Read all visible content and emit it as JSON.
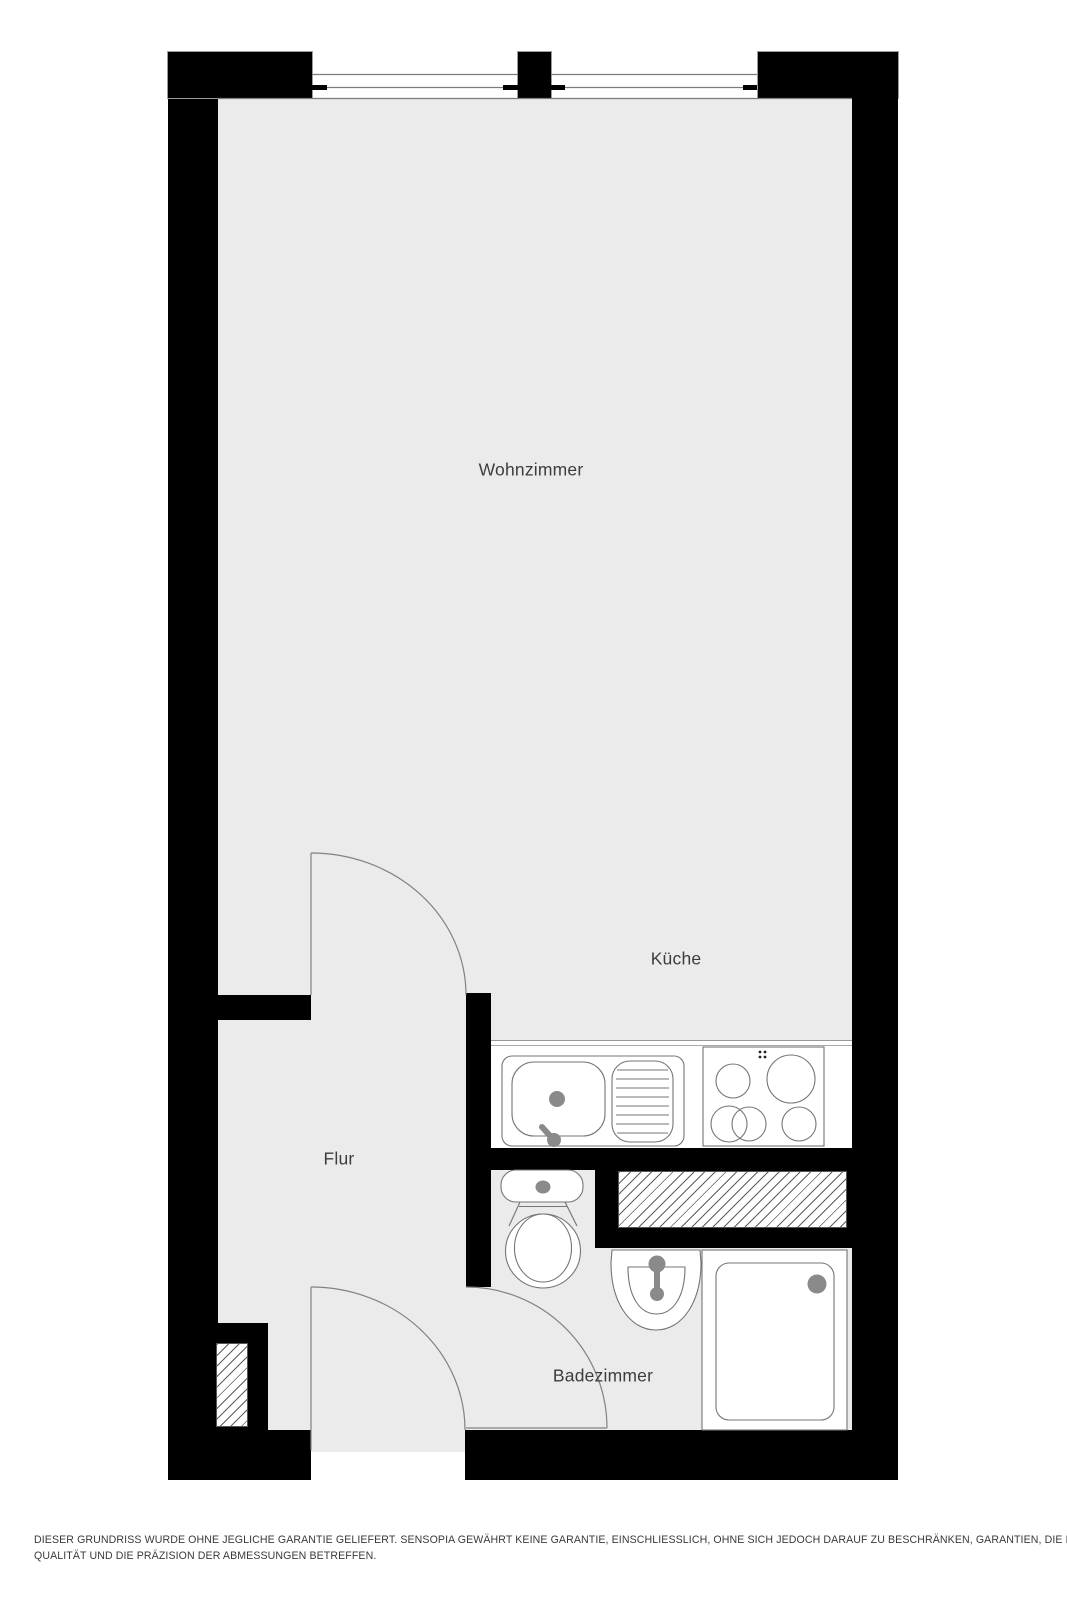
{
  "document": {
    "type": "floor-plan",
    "language": "de"
  },
  "rooms": [
    {
      "id": "wohnzimmer",
      "label": "Wohnzimmer"
    },
    {
      "id": "kueche",
      "label": "Küche"
    },
    {
      "id": "flur",
      "label": "Flur"
    },
    {
      "id": "badezimmer",
      "label": "Badezimmer"
    }
  ],
  "fixtures": {
    "kitchen": [
      "kitchen-sink",
      "drainboard",
      "cooktop"
    ],
    "bathroom": [
      "toilet",
      "washbasin",
      "shower-tray"
    ],
    "symbols": [
      "door-swing",
      "window",
      "duct-shaft"
    ]
  },
  "disclaimer": {
    "line1": "DIESER GRUNDRISS WURDE OHNE JEGLICHE GARANTIE GELIEFERT. SENSOPIA GEWÄHRT KEINE GARANTIE, EINSCHLIESSLICH, OHNE SICH JEDOCH DARAUF ZU BESCHRÄNKEN, GARANTIEN, DIE DIE",
    "line2": "QUALITÄT UND DIE PRÄZISION DER ABMESSUNGEN BETREFFEN."
  },
  "colors": {
    "wall": "#000000",
    "floor": "#ebebeb",
    "outline": "#757575",
    "accent": "#8a8a8a",
    "label": "#3d3d3d",
    "disclaimer": "#3a3a3a"
  }
}
